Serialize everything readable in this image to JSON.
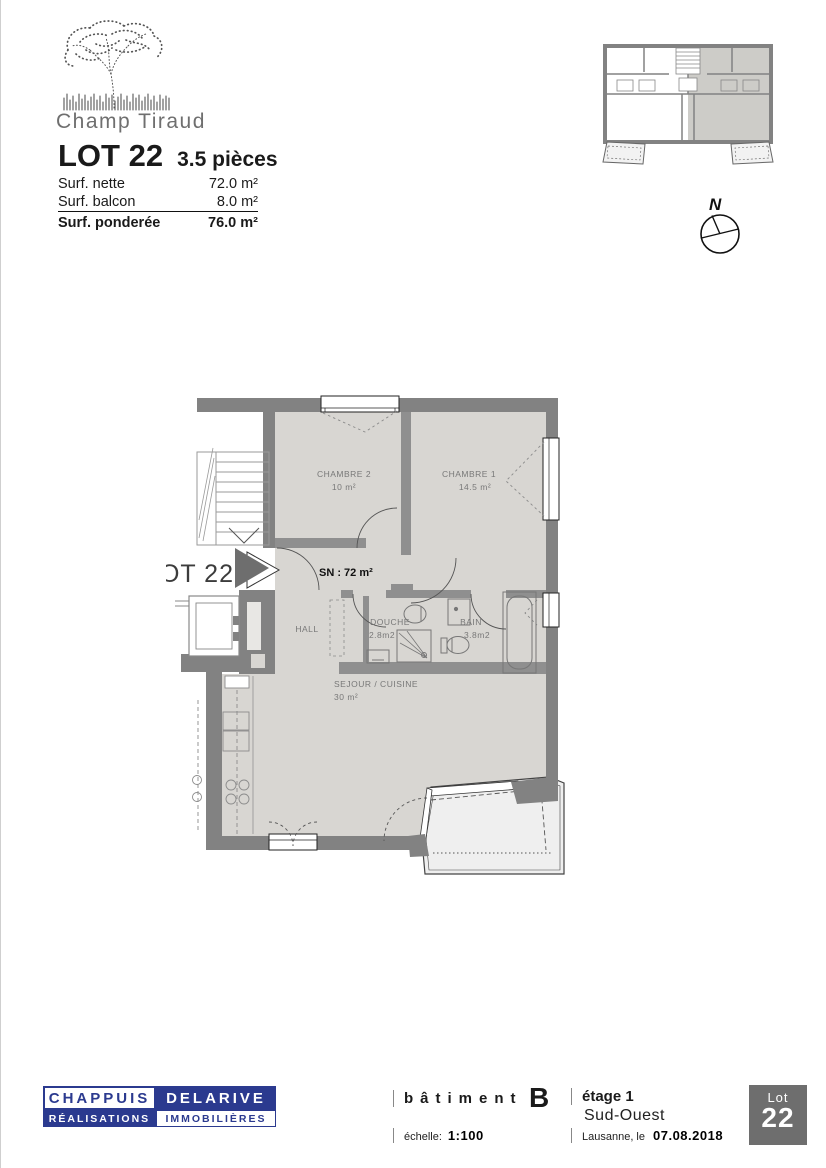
{
  "brand": {
    "name": "Champ Tiraud"
  },
  "lot_header": {
    "title": "LOT 22",
    "pieces": "3.5 pièces"
  },
  "surfaces": {
    "nette_label": "Surf. nette",
    "nette_value": "72.0 m²",
    "balcon_label": "Surf. balcon",
    "balcon_value": "8.0 m²",
    "ponderee_label": "Surf. ponderée",
    "ponderee_value": "76.0 m²"
  },
  "compass": {
    "north": "N"
  },
  "floor_plan": {
    "lot_label": "LOT 22",
    "surface_note": "SN : 72 m²",
    "chambre2": {
      "name": "CHAMBRE 2",
      "area": "10 m²"
    },
    "chambre1": {
      "name": "CHAMBRE 1",
      "area": "14.5 m²"
    },
    "hall": {
      "name": "HALL"
    },
    "douche": {
      "name": "DOUCHE",
      "area": "2.8m2"
    },
    "bain": {
      "name": "BAIN",
      "area": "3.8m2"
    },
    "sejour": {
      "name": "SEJOUR / CUISINE",
      "area": "30 m²"
    }
  },
  "footer": {
    "logo": {
      "top_left": "CHAPPUIS",
      "top_right": "DELARIVE",
      "bottom_left": "RÉALISATIONS",
      "bottom_right": "IMMOBILIÈRES"
    },
    "batiment_label": "bâtiment",
    "batiment_value": "B",
    "echelle_label": "échelle:",
    "echelle_value": "1:100",
    "etage": "étage 1",
    "orientation": "Sud-Ouest",
    "date_label": "Lausanne, le",
    "date_value": "07.08.2018",
    "lot_badge": {
      "label": "Lot",
      "number": "22"
    }
  },
  "colors": {
    "brand_blue": "#2b3a8f",
    "wall_gray": "#828282",
    "room_fill": "#d8d6d2",
    "balcony_fill": "#efefef",
    "badge_gray": "#6e6e6e"
  }
}
